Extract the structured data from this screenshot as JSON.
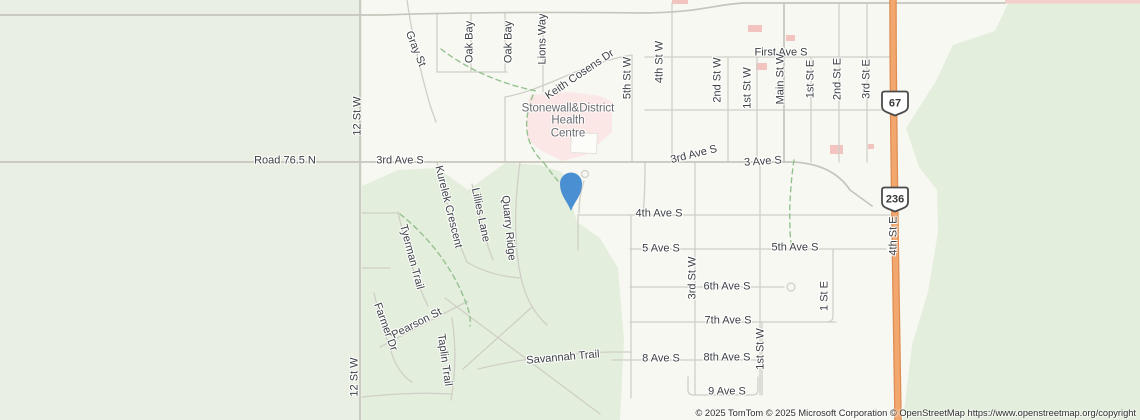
{
  "map": {
    "attribution": "© 2025 TomTom © 2025 Microsoft Corporation © OpenStreetMap https://www.openstreetmap.org/copyright",
    "poi": {
      "name": "Stonewall&District Health Centre",
      "lines": [
        "Stonewall&District",
        "Health",
        "Centre"
      ]
    },
    "pin": {
      "x": 571,
      "y": 212,
      "color": "#4a8fd2"
    },
    "shields": [
      {
        "label": "67",
        "x": 895,
        "y": 103
      },
      {
        "label": "236",
        "x": 895,
        "y": 199
      }
    ],
    "street_labels": [
      {
        "text": "Gray St",
        "x": 415,
        "y": 49,
        "rot": 68
      },
      {
        "text": "Oak Bay",
        "x": 470,
        "y": 42,
        "rot": -90
      },
      {
        "text": "Oak Bay",
        "x": 509,
        "y": 42,
        "rot": -90
      },
      {
        "text": "Lions Way",
        "x": 543,
        "y": 39,
        "rot": -90
      },
      {
        "text": "Keith Cosens Dr",
        "x": 580,
        "y": 75,
        "rot": -34
      },
      {
        "text": "5th St W",
        "x": 628,
        "y": 78,
        "rot": -90
      },
      {
        "text": "4th St W",
        "x": 660,
        "y": 62,
        "rot": -90
      },
      {
        "text": "First Ave S",
        "x": 781,
        "y": 53,
        "rot": 0
      },
      {
        "text": "2nd St W",
        "x": 718,
        "y": 80,
        "rot": -90
      },
      {
        "text": "1st St W",
        "x": 748,
        "y": 88,
        "rot": -90
      },
      {
        "text": "Main St W",
        "x": 781,
        "y": 79,
        "rot": -90
      },
      {
        "text": "1st St E",
        "x": 811,
        "y": 79,
        "rot": -90
      },
      {
        "text": "2nd St E",
        "x": 838,
        "y": 79,
        "rot": -90
      },
      {
        "text": "3rd St E",
        "x": 867,
        "y": 79,
        "rot": -90
      },
      {
        "text": "12 St W",
        "x": 358,
        "y": 116,
        "rot": -90
      },
      {
        "text": "Road 76.5 N",
        "x": 285,
        "y": 161,
        "rot": 0
      },
      {
        "text": "3rd Ave S",
        "x": 400,
        "y": 161,
        "rot": 0
      },
      {
        "text": "3rd Ave S",
        "x": 694,
        "y": 155,
        "rot": -14
      },
      {
        "text": "3 Ave S",
        "x": 763,
        "y": 162,
        "rot": -4
      },
      {
        "text": "4th St E",
        "x": 894,
        "y": 236,
        "rot": -90
      },
      {
        "text": "4th Ave S",
        "x": 659,
        "y": 214,
        "rot": 0
      },
      {
        "text": "Kurelek Crescent",
        "x": 448,
        "y": 207,
        "rot": 76
      },
      {
        "text": "Lillies Lane",
        "x": 480,
        "y": 215,
        "rot": 78
      },
      {
        "text": "Quarry Ridge",
        "x": 508,
        "y": 228,
        "rot": 84
      },
      {
        "text": "Tyerman Trail",
        "x": 411,
        "y": 257,
        "rot": 75
      },
      {
        "text": "5 Ave S",
        "x": 661,
        "y": 249,
        "rot": 0
      },
      {
        "text": "5th Ave S",
        "x": 795,
        "y": 248,
        "rot": 0
      },
      {
        "text": "3rd St W",
        "x": 693,
        "y": 278,
        "rot": -90
      },
      {
        "text": "6th Ave S",
        "x": 727,
        "y": 287,
        "rot": 0
      },
      {
        "text": "1 St E",
        "x": 825,
        "y": 296,
        "rot": -90
      },
      {
        "text": "7th Ave S",
        "x": 728,
        "y": 321,
        "rot": 0
      },
      {
        "text": "Farmer Dr",
        "x": 385,
        "y": 327,
        "rot": 70
      },
      {
        "text": "Pearson St",
        "x": 417,
        "y": 324,
        "rot": -27
      },
      {
        "text": "Taplin Trail",
        "x": 444,
        "y": 360,
        "rot": 82
      },
      {
        "text": "Savannah Trail",
        "x": 563,
        "y": 358,
        "rot": -5
      },
      {
        "text": "8 Ave S",
        "x": 661,
        "y": 359,
        "rot": 0
      },
      {
        "text": "8th Ave S",
        "x": 727,
        "y": 358,
        "rot": 0
      },
      {
        "text": "1st St W",
        "x": 761,
        "y": 349,
        "rot": -90
      },
      {
        "text": "9 Ave S",
        "x": 727,
        "y": 392,
        "rot": 0
      },
      {
        "text": "12 St W",
        "x": 355,
        "y": 377,
        "rot": -90
      }
    ],
    "colors": {
      "land": "#f8f8f3",
      "green": "#e4eedd",
      "green-light": "#e9f0e3",
      "road": "#cfcfc7",
      "road-major": "#c5c5bc",
      "highway-fill": "#f2a76f",
      "highway-casing": "#de8c51",
      "trail": "#94c28f",
      "hospital": "#fbe7e5",
      "building-pink": "#f3c3c0",
      "label": "#3c4045",
      "poi-label": "#686d72",
      "pin": "#4a8fd2",
      "attribution": "#2e2e2e",
      "shield-border": "#4b4b4b"
    }
  }
}
